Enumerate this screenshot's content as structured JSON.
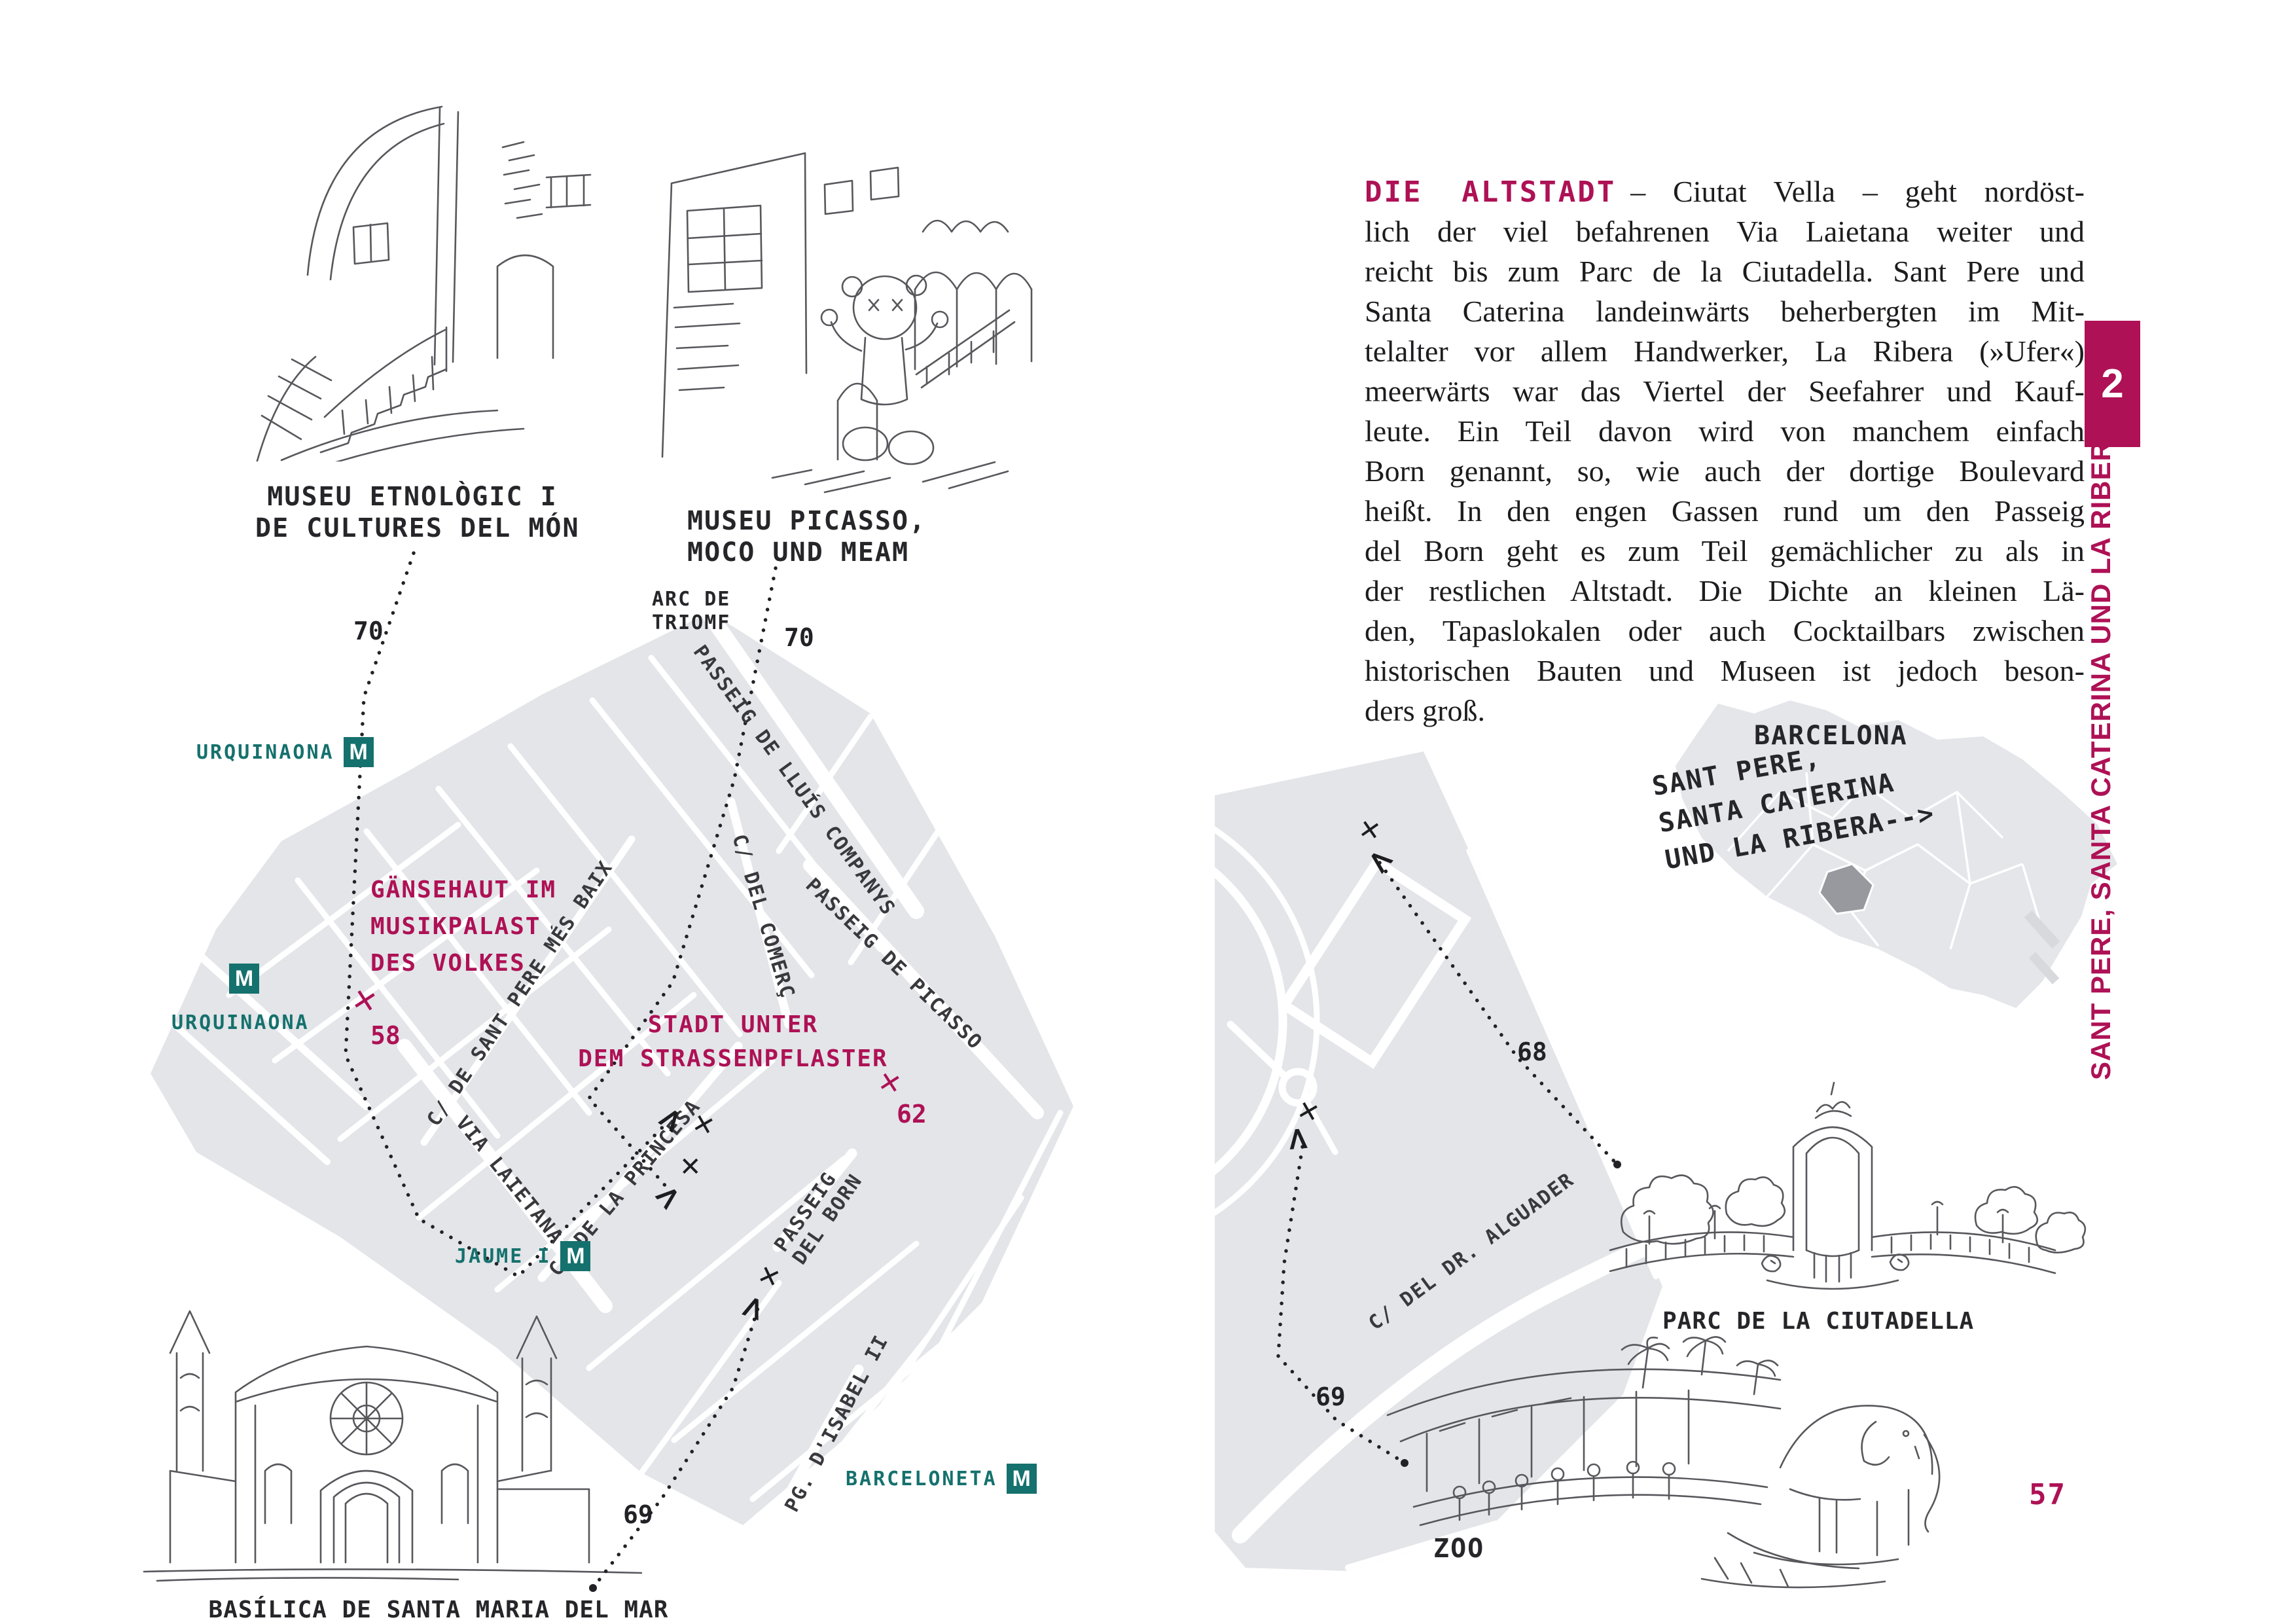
{
  "colors": {
    "accent": "#ae1155",
    "teal": "#15716d",
    "map_gray": "#e3e5e9",
    "district_highlight": "#97999e"
  },
  "markers": {
    "x": "✕",
    "chevron": ">"
  },
  "sidebar": {
    "chapter_number": "2",
    "vertical_title": "SANT PERE, SANTA CATERINA UND LA RIBERA",
    "page_number": "57"
  },
  "article": {
    "lead": "DIE ALTSTADT",
    "lines": [
      "– Ciutat Vella – geht nordöst-",
      "lich der viel befahrenen Via Laietana weiter und",
      "reicht bis zum Parc de la Ciutadella. Sant Pere und",
      "Santa Caterina landeinwärts beherbergten im Mit-",
      "telalter vor allem Handwerker, La Ribera (»Ufer«)",
      "meerwärts war das Viertel der Seefahrer und Kauf-",
      "leute. Ein Teil davon wird von manchem einfach",
      "Born genannt, so, wie auch der dortige Boulevard",
      "heißt. In den engen Gassen rund um den Passeig",
      "del Born geht es zum Teil gemächlicher zu als in",
      "der restlichen Altstadt. Die Dichte an kleinen Lä-",
      "den, Tapaslokalen oder auch Cocktailbars zwischen",
      "historischen Bauten und Museen ist jedoch beson-",
      "ders groß."
    ]
  },
  "left": {
    "captions": {
      "etnologic1": "MUSEU ETNOLÒGIC I",
      "etnologic2": "DE CULTURES DEL MÓN",
      "picasso1": "MUSEU PICASSO,",
      "picasso2": "MOCO UND MEAM",
      "basilica": "BASÍLICA DE SANTA MARIA DEL MAR"
    },
    "numbers": {
      "etnologic": "70",
      "picasso": "70",
      "musikpalast": "58",
      "strassenpflaster": "62",
      "basilica": "69"
    },
    "pois": {
      "musikpalast1": "GÄNSEHAUT IM",
      "musikpalast2": "MUSIKPALAST",
      "musikpalast3": "DES VOLKES",
      "strassenpflaster1": "STADT UNTER",
      "strassenpflaster2": "DEM STRASSENPFLASTER"
    },
    "streets": {
      "arc1": "ARC DE",
      "arc2": "TRIOMF",
      "companys": "PASSEIG DE LLUÍS COMPANYS",
      "santpere": "C/ DE SANT PERE MÉS BAIX",
      "comerc": "C/ DEL COMERÇ",
      "picasso": "PASSEIG DE PICASSO",
      "laietana": "VIA LAIETANA",
      "princesa": "C/ DE LA PRINCESA",
      "born1": "PASSEIG",
      "born2": "DEL BORN",
      "isabel": "PG. D'ISABEL II"
    },
    "metro": {
      "m": "M",
      "urquinaona_top": "URQUINAONA",
      "urquinaona_left": "URQUINAONA",
      "jaume": "JAUME I",
      "barceloneta": "BARCELONETA"
    }
  },
  "right": {
    "streets": {
      "alguader": "C/ DEL DR. ALGUADER"
    },
    "numbers": {
      "ciutadella": "68",
      "zoo": "69"
    },
    "captions": {
      "parc": "PARC DE LA CIUTADELLA",
      "zoo": "ZOO"
    },
    "inset": {
      "title": "BARCELONA",
      "label1": "SANT PERE,",
      "label2": "SANTA CATERINA",
      "label3": "UND LA RIBERA-->"
    }
  }
}
